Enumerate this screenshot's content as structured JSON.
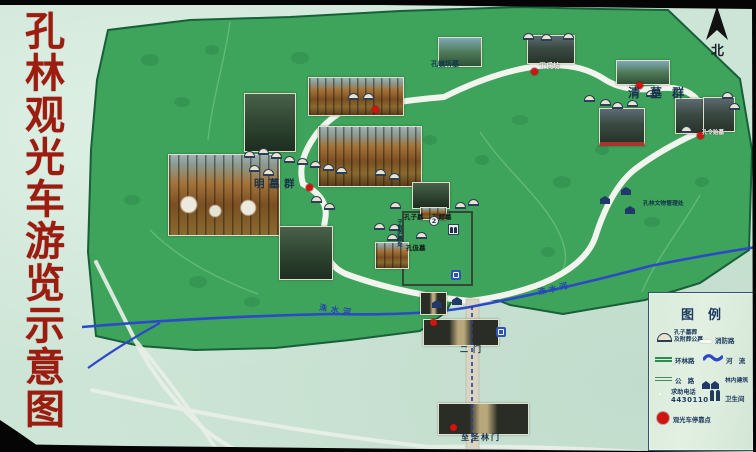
{
  "board": {
    "title": "孔林观光车游览示意图",
    "compass_label": "北"
  },
  "map": {
    "area_labels": {
      "kong_yuqi_tomb": "孔毓圻墓",
      "yu_shi_archway": "于氏坊",
      "qing_tombs": "清墓群",
      "kong_lingyi_tomb": "孔令贻墓",
      "ming_tombs": "明墓群",
      "relics_office": "孔林文物管理处",
      "kongzi_tomb": "孔子墓",
      "kongli_tomb": "孔鲤墓",
      "kongji_tomb": "孔伋墓",
      "zigong_hut": "子贡庐墓处",
      "second_gate": "二门",
      "forest_gate": "至圣林门",
      "river_west": "洙水河",
      "river_east": "洙水河",
      "marker_2": "2"
    }
  },
  "legend": {
    "title": "图例",
    "items": [
      {
        "icon": "tomb-mound-icon",
        "label": "孔子墓葬",
        "label2": "及附葬公墓"
      },
      {
        "icon": "fire-road-icon",
        "label": "消防路"
      },
      {
        "icon": "ring-road-icon",
        "label": "环林路"
      },
      {
        "icon": "river-icon",
        "label": "河 流"
      },
      {
        "icon": "highway-icon",
        "label": "公 路"
      },
      {
        "icon": "building-icon",
        "label": "林内建筑"
      },
      {
        "icon": "phone-icon",
        "label": "求助电话",
        "label2": "4430110"
      },
      {
        "icon": "toilet-icon",
        "label": "卫生间"
      },
      {
        "icon": "bus-stop-icon",
        "label": "观光车停靠点"
      }
    ]
  },
  "colors": {
    "title_red": "#9c1c10",
    "forest_green": "#3ea35b",
    "river_blue": "#2b49c8",
    "bus_stop_red": "#d01510"
  }
}
